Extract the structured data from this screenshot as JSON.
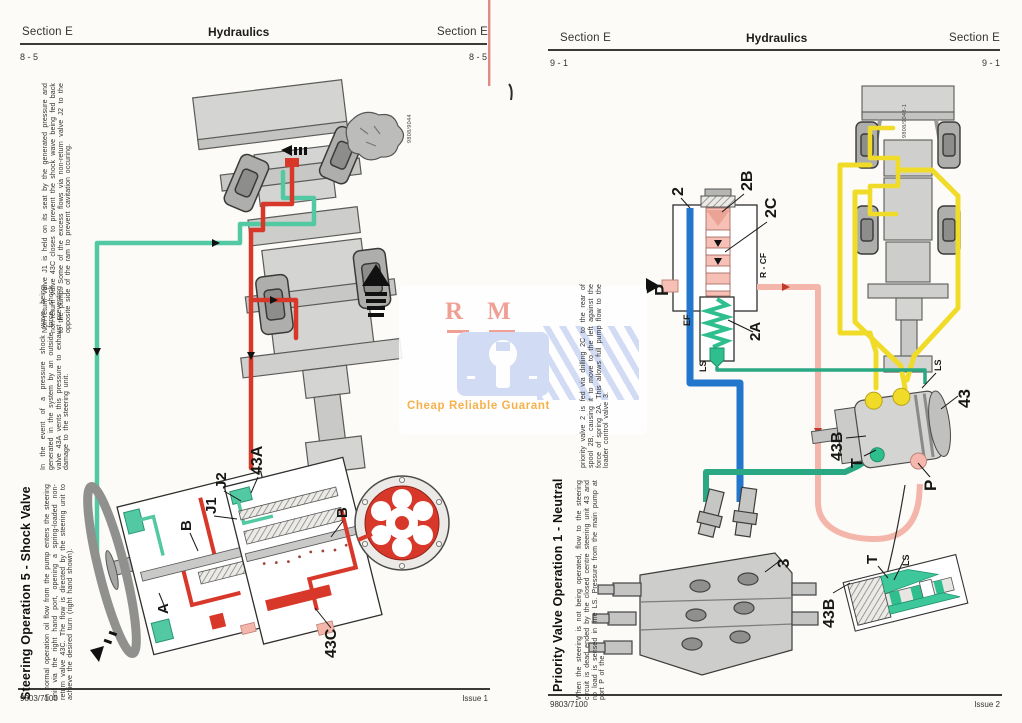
{
  "watermark": {
    "letter_r": "R",
    "letter_m": "M",
    "tagline": "Cheap Reliable Guarant"
  },
  "colors": {
    "pressure_red": "#d8382a",
    "exhaust_teal": "#52c9a2",
    "ls_teal": "#2aa884",
    "ef_blue": "#2277cc",
    "pump_yellow": "#f0dc28",
    "rcf_pink": "#f4b6ab",
    "spring_green": "#2fbf8f",
    "watermark_blue": "#ced8f4",
    "watermark_orange": "#f6a93b",
    "watermark_red": "#ef968b"
  },
  "left_page": {
    "header_left": "Section E",
    "header_center": "Hydraulics",
    "header_right": "Section E",
    "page_no_left": "8 - 5",
    "page_no_right": "8 - 5",
    "figure_code": "9808/9044",
    "title": "Steering Operation 5 - Shock Valve",
    "para_normal": "In normal operation oil flow from the pump enters the steering unit via the right hand port, opening a spring-loaded non-return valve 43C. The flow is directed by the steering unit to achieve the desired turn (right hand shown).",
    "para_event": "In the event of a pressure shock wave being generated in the system by an outside force, shock valve 43A vents this pressure to exhaust preventing damage to the steering unit.",
    "para_nonreturn": "Non-return valve J1 is held on its seat by the generated pressure and non-return valve 43C closes to prevent the shock wave being fed back to the pump. Some of the excess flows via non-return valve J2 to the opposite side of the ram to prevent cavitation occuring.",
    "labels": {
      "b_left": "B",
      "a": "A",
      "j1": "J1",
      "j2": "J2",
      "v43a": "43A",
      "b_right": "B",
      "v43c": "43C"
    },
    "footer_left": "9803/7100",
    "footer_right": "Issue 1"
  },
  "right_page": {
    "header_left": "Section E",
    "header_center": "Hydraulics",
    "header_right": "Section E",
    "page_no_left": "9 - 1",
    "page_no_right": "9 - 1",
    "figure_code": "9808/9048-1",
    "title": "Priority Valve Operation 1 - Neutral",
    "para_neutral": "When the steering is not being operated, flow to the steering circuit is dead ended by the closed centre steering unit 43 and no load is sensed in line LS. Pressure from the main pump at port P of the",
    "para_priority": "priority valve 2 is fed via drilling 2C to the rear of spool 2B, causing it to move to the left against the force of spring 2A. This allows full pump flow to the loader control valve 3.",
    "labels": {
      "n2": "2",
      "n2b": "2B",
      "n2c": "2C",
      "p": "P",
      "rcf": "R - CF",
      "ef": "EF",
      "n2a": "2A",
      "ls_valve": "LS",
      "n43": "43",
      "ls_unit": "LS",
      "n43b": "43B",
      "t_unit": "T",
      "p_unit": "P",
      "n3": "3",
      "t_inset": "T",
      "ls_inset": "LS",
      "n43b_inset": "43B"
    },
    "footer_left": "9803/7100",
    "footer_right": "Issue 2"
  }
}
